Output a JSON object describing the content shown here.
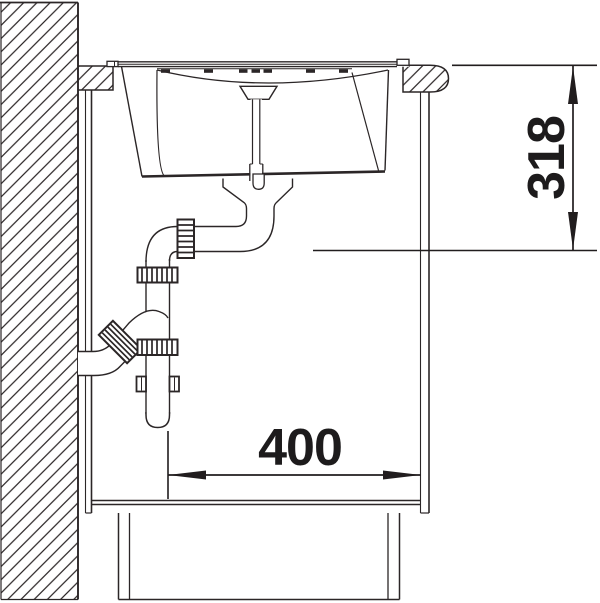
{
  "page": {
    "background": "#ffffff"
  },
  "drawing": {
    "kind": "sink-installation-section-drawing",
    "dimension_labels": {
      "vertical": "318",
      "horizontal": "400"
    },
    "colors": {
      "line": "#2b2627",
      "dimension_text": "#1d1b1c",
      "background": "#ffffff"
    },
    "components": [
      "wall-hatched",
      "countertop-left-section",
      "countertop-bullnose-section",
      "cabinet-left-panel",
      "cabinet-right-panel",
      "cabinet-bottom-shelf",
      "plinth",
      "sink-rim",
      "sink-bowl",
      "overflow-standpipe",
      "drain-flange",
      "trap-elbow",
      "trap-vertical-pipe",
      "trap-coupling-nuts",
      "wall-outlet-pipe",
      "pipe-clamp",
      "dimension-vertical",
      "dimension-horizontal"
    ]
  }
}
